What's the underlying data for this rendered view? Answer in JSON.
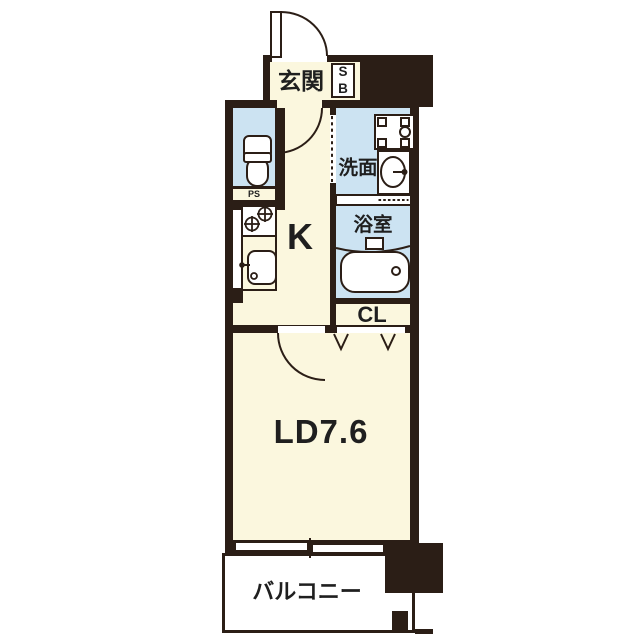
{
  "floorplan": {
    "colors": {
      "wall": "#2B1E16",
      "floor": "#FBF7DE",
      "wet_area": "#CCE3F2",
      "balcony_fill": "#FFFFFF",
      "text": "#1F1F1F"
    },
    "rooms": {
      "genkan": {
        "label": "玄関"
      },
      "shoe_box": {
        "label_top": "S",
        "label_bottom": "B"
      },
      "pipe_space": {
        "label": "PS"
      },
      "washroom": {
        "label": "洗面"
      },
      "bathroom": {
        "label": "浴室"
      },
      "kitchen": {
        "label": "K"
      },
      "closet": {
        "label": "CL"
      },
      "living_dining": {
        "label": "LD7.6"
      },
      "balcony": {
        "label": "バルコニー"
      }
    },
    "icons": {
      "entrance_door": "swing-door-arc",
      "hall_door": "swing-door-arc",
      "ld_door": "swing-door-arc",
      "washroom_door": "dashed-sliding-door",
      "bathroom_door": "dotted-folding-door",
      "closet_doors": "v-hinge-marks",
      "toilet": "toilet",
      "washing_machine": "washer-pan",
      "washbasin": "basin-with-faucet",
      "bathtub": "bathtub",
      "stove": "two-burner-stove",
      "kitchen_sink": "sink-with-faucet",
      "ld_window": "sliding-window"
    }
  }
}
